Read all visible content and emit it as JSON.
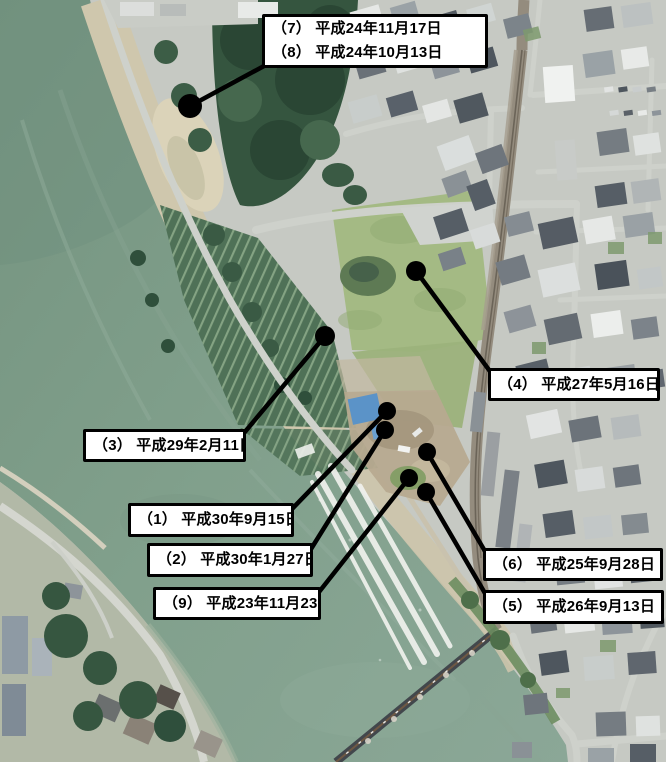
{
  "colors": {
    "callout_bg": "#ffffff",
    "callout_border": "#000000",
    "callout_text": "#000000",
    "marker": "#000000",
    "leader": "#000000"
  },
  "callouts": [
    {
      "id": "7-8",
      "lines": [
        "（7） 平成24年11月17日",
        "（8） 平成24年10月13日"
      ],
      "box": {
        "x": 262,
        "y": 14,
        "w": 226,
        "h": 54
      },
      "dot": {
        "x": 190,
        "y": 106,
        "r": 12
      },
      "anchor": {
        "x": 264,
        "y": 66
      }
    },
    {
      "id": "4",
      "lines": [
        "（4） 平成27年5月16日"
      ],
      "box": {
        "x": 488,
        "y": 368,
        "w": 172,
        "h": 33
      },
      "dot": {
        "x": 416,
        "y": 271,
        "r": 10
      },
      "anchor": {
        "x": 492,
        "y": 374
      }
    },
    {
      "id": "3",
      "lines": [
        "（3） 平成29年2月11日"
      ],
      "box": {
        "x": 83,
        "y": 429,
        "w": 163,
        "h": 33
      },
      "dot": {
        "x": 325,
        "y": 336,
        "r": 10
      },
      "anchor": {
        "x": 244,
        "y": 433
      }
    },
    {
      "id": "1",
      "lines": [
        "（1） 平成30年9月15日"
      ],
      "box": {
        "x": 128,
        "y": 503,
        "w": 166,
        "h": 34
      },
      "dot": {
        "x": 387,
        "y": 411,
        "r": 9
      },
      "anchor": {
        "x": 292,
        "y": 509
      }
    },
    {
      "id": "2",
      "lines": [
        "（2） 平成30年1月27日"
      ],
      "box": {
        "x": 147,
        "y": 543,
        "w": 166,
        "h": 34
      },
      "dot": {
        "x": 385,
        "y": 430,
        "r": 9
      },
      "anchor": {
        "x": 311,
        "y": 549
      }
    },
    {
      "id": "9",
      "lines": [
        "（9） 平成23年11月23日"
      ],
      "box": {
        "x": 153,
        "y": 587,
        "w": 168,
        "h": 33
      },
      "dot": {
        "x": 409,
        "y": 478,
        "r": 9
      },
      "anchor": {
        "x": 319,
        "y": 592
      }
    },
    {
      "id": "6",
      "lines": [
        "（6） 平成25年9月28日"
      ],
      "box": {
        "x": 483,
        "y": 548,
        "w": 180,
        "h": 33
      },
      "dot": {
        "x": 427,
        "y": 452,
        "r": 9
      },
      "anchor": {
        "x": 486,
        "y": 553
      }
    },
    {
      "id": "5",
      "lines": [
        "（5） 平成26年9月13日"
      ],
      "box": {
        "x": 483,
        "y": 590,
        "w": 181,
        "h": 34
      },
      "dot": {
        "x": 426,
        "y": 492,
        "r": 9
      },
      "anchor": {
        "x": 486,
        "y": 595
      }
    }
  ]
}
